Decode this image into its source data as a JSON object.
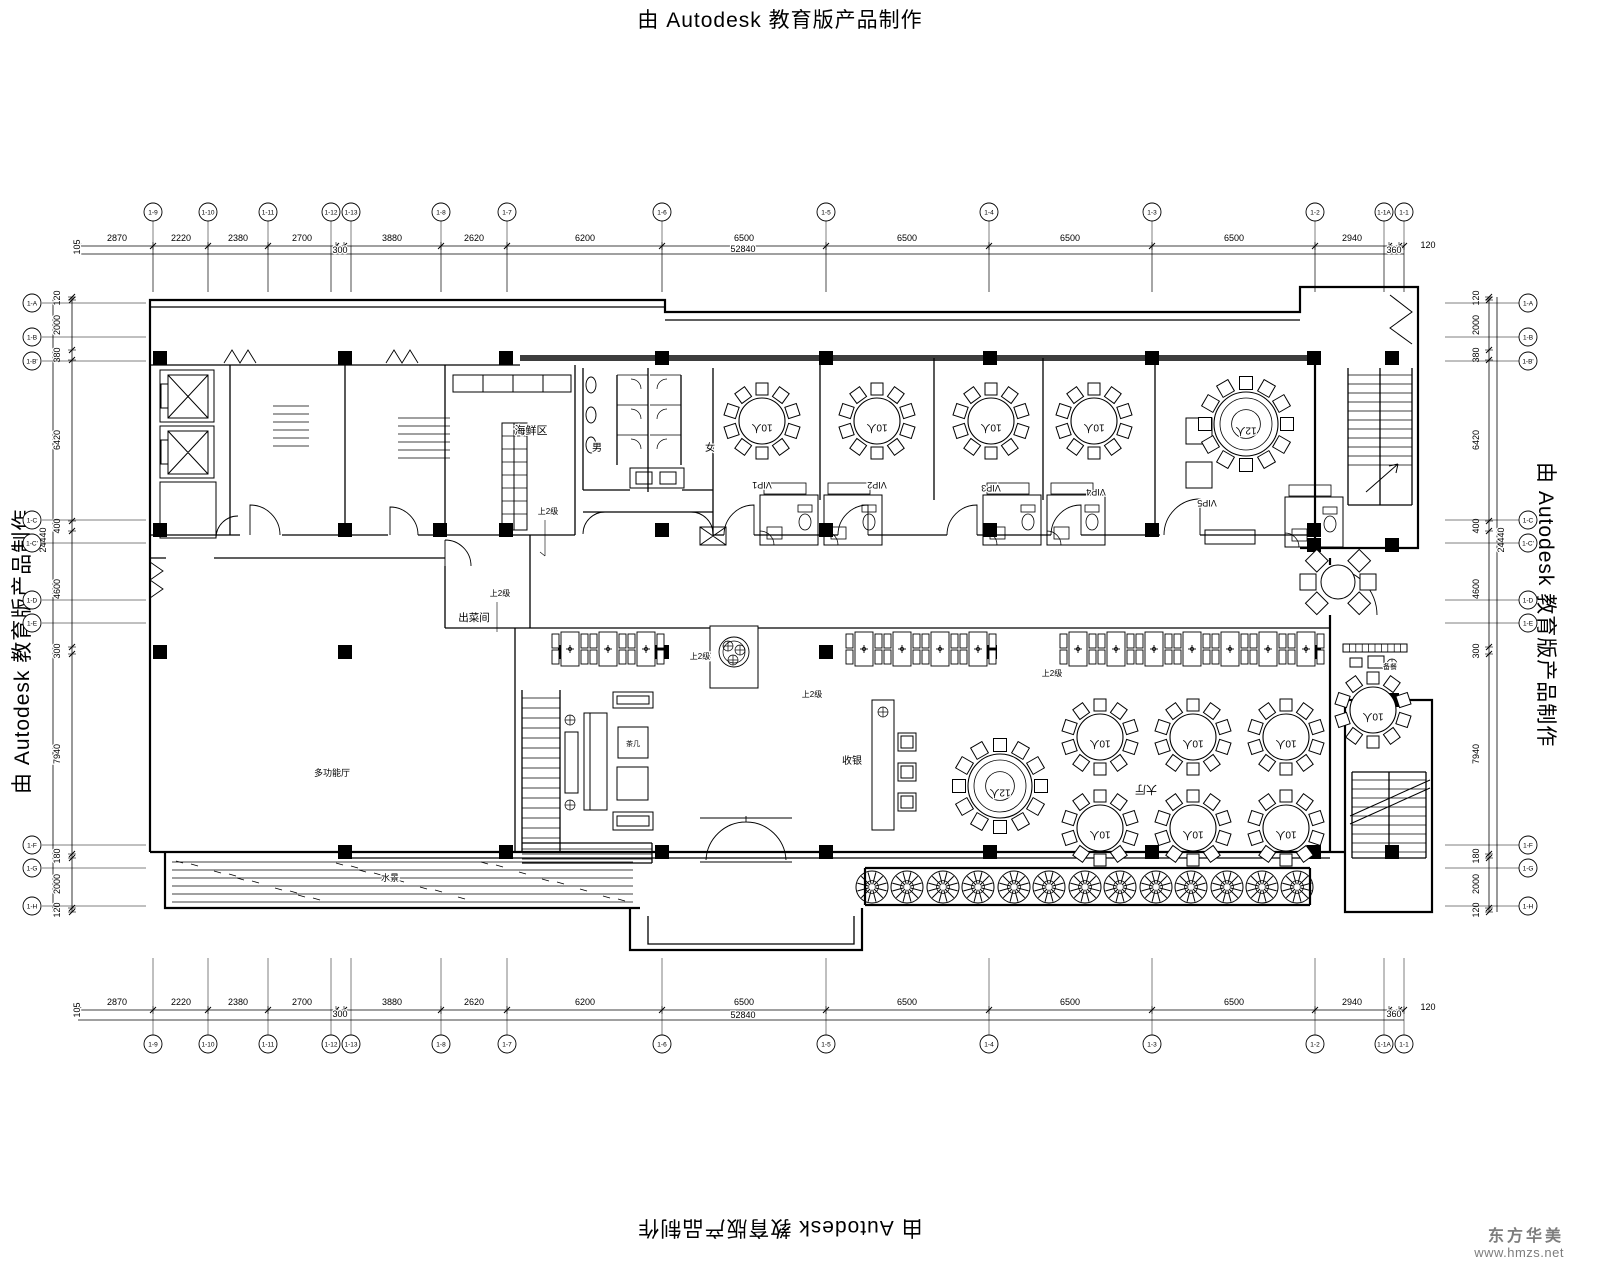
{
  "watermarks": {
    "top": "由 Autodesk 教育版产品制作",
    "left": "由 Autodesk 教育版产品制作",
    "right": "由 Autodesk 教育版产品制作",
    "bottom": "由 Autodesk 教育版产品制作"
  },
  "logo": {
    "name": "东方华美",
    "url": "www.hmzs.net",
    "color": "#7d7d7d"
  },
  "sheet": {
    "bg": "#ffffff",
    "line": "#000000",
    "heavy": "#3d3d3d"
  },
  "axes": {
    "top": {
      "y": 212,
      "labels": [
        "1-9",
        "1-10",
        "1-11",
        "1-12",
        "1-13",
        "1-8",
        "1-7",
        "1-6",
        "1-5",
        "1-4",
        "1-3",
        "1-2",
        "1-1A",
        "1-1"
      ],
      "x": [
        153,
        208,
        268,
        331,
        351,
        441,
        507,
        662,
        826,
        989,
        1152,
        1315,
        1384,
        1404
      ]
    },
    "bottom": {
      "y": 1044,
      "labels": [
        "1-9",
        "1-10",
        "1-11",
        "1-12",
        "1-13",
        "1-8",
        "1-7",
        "1-6",
        "1-5",
        "1-4",
        "1-3",
        "1-2",
        "1-1A",
        "1-1"
      ],
      "x": [
        153,
        208,
        268,
        331,
        351,
        441,
        507,
        662,
        826,
        989,
        1152,
        1315,
        1384,
        1404
      ]
    },
    "left": {
      "x": 32,
      "labels": [
        "1-A",
        "1-B",
        "1-B'",
        "1-C",
        "1-C'",
        "1-D",
        "1-E",
        "1-F",
        "1-G",
        "1-H"
      ],
      "y": [
        303,
        337,
        361,
        520,
        543,
        600,
        623,
        845,
        868,
        906
      ]
    },
    "right": {
      "x": 1528,
      "labels": [
        "1-A",
        "1-B",
        "1-B'",
        "1-C",
        "1-C'",
        "1-D",
        "1-E",
        "1-F",
        "1-G",
        "1-H"
      ],
      "y": [
        303,
        337,
        361,
        520,
        543,
        600,
        623,
        845,
        868,
        906
      ]
    }
  },
  "dimensions": {
    "top": {
      "items": [
        [
          "105",
          80,
          247,
          1
        ],
        [
          "2870",
          117,
          241,
          0
        ],
        [
          "2220",
          181,
          241,
          0
        ],
        [
          "2380",
          238,
          241,
          0
        ],
        [
          "2700",
          302,
          241,
          0
        ],
        [
          "300",
          340,
          253,
          0
        ],
        [
          "3880",
          392,
          241,
          0
        ],
        [
          "2620",
          474,
          241,
          0
        ],
        [
          "6200",
          585,
          241,
          0
        ],
        [
          "6500",
          744,
          241,
          0
        ],
        [
          "6500",
          907,
          241,
          0
        ],
        [
          "6500",
          1070,
          241,
          0
        ],
        [
          "6500",
          1234,
          241,
          0
        ],
        [
          "2940",
          1352,
          241,
          0
        ],
        [
          "360",
          1394,
          253,
          0
        ],
        [
          "120",
          1428,
          248,
          0
        ]
      ],
      "total": "52840"
    },
    "bottom": {
      "items": [
        [
          "105",
          80,
          1010,
          1
        ],
        [
          "2870",
          117,
          1005,
          0
        ],
        [
          "2220",
          181,
          1005,
          0
        ],
        [
          "2380",
          238,
          1005,
          0
        ],
        [
          "2700",
          302,
          1005,
          0
        ],
        [
          "300",
          340,
          1017,
          0
        ],
        [
          "3880",
          392,
          1005,
          0
        ],
        [
          "2620",
          474,
          1005,
          0
        ],
        [
          "6200",
          585,
          1005,
          0
        ],
        [
          "6500",
          744,
          1005,
          0
        ],
        [
          "6500",
          907,
          1005,
          0
        ],
        [
          "6500",
          1070,
          1005,
          0
        ],
        [
          "6500",
          1234,
          1005,
          0
        ],
        [
          "2940",
          1352,
          1005,
          0
        ],
        [
          "360",
          1394,
          1017,
          0
        ],
        [
          "120",
          1428,
          1010,
          0
        ]
      ],
      "total": "52840"
    },
    "left": {
      "items": [
        [
          "120",
          298
        ],
        [
          "2000",
          325
        ],
        [
          "380",
          355
        ],
        [
          "6420",
          440
        ],
        [
          "400",
          526
        ],
        [
          "4600",
          589
        ],
        [
          "300",
          651
        ],
        [
          "7940",
          754
        ],
        [
          "180",
          856
        ],
        [
          "2000",
          884
        ],
        [
          "120",
          910
        ]
      ],
      "total": "24440"
    },
    "right": {
      "items": [
        [
          "120",
          298
        ],
        [
          "2000",
          325
        ],
        [
          "380",
          355
        ],
        [
          "6420",
          440
        ],
        [
          "400",
          526
        ],
        [
          "4600",
          589
        ],
        [
          "300",
          651
        ],
        [
          "7940",
          754
        ],
        [
          "180",
          856
        ],
        [
          "2000",
          884
        ],
        [
          "120",
          910
        ]
      ],
      "total": "24440"
    }
  },
  "labels": [
    {
      "t": "海鲜区",
      "x": 531,
      "y": 434,
      "s": 11,
      "r": 0
    },
    {
      "t": "男",
      "x": 597,
      "y": 451,
      "s": 10,
      "r": 0
    },
    {
      "t": "女",
      "x": 710,
      "y": 451,
      "s": 10,
      "r": 0
    },
    {
      "t": "出菜间",
      "x": 474,
      "y": 621,
      "s": 10.5,
      "r": 0
    },
    {
      "t": "收银",
      "x": 852,
      "y": 764,
      "s": 10,
      "r": 0
    },
    {
      "t": "大厅",
      "x": 1146,
      "y": 786,
      "s": 11,
      "r": 180
    },
    {
      "t": "VIP1",
      "x": 762,
      "y": 482,
      "s": 9,
      "r": 180
    },
    {
      "t": "VIP2",
      "x": 877,
      "y": 482,
      "s": 9,
      "r": 180
    },
    {
      "t": "VIP3",
      "x": 991,
      "y": 485,
      "s": 9,
      "r": 180
    },
    {
      "t": "VIP4",
      "x": 1096,
      "y": 489,
      "s": 9,
      "r": 180
    },
    {
      "t": "VIP5",
      "x": 1207,
      "y": 500,
      "s": 9,
      "r": 180
    },
    {
      "t": "多功能厅",
      "x": 332,
      "y": 776,
      "s": 9,
      "r": 0
    },
    {
      "t": "水景",
      "x": 390,
      "y": 881,
      "s": 9,
      "r": 0
    },
    {
      "t": "茶几",
      "x": 633,
      "y": 746,
      "s": 7,
      "r": 0
    },
    {
      "t": "备餐",
      "x": 1390,
      "y": 669,
      "s": 7,
      "r": 0
    },
    {
      "t": "上2级",
      "x": 548,
      "y": 514,
      "s": 8,
      "r": 0
    },
    {
      "t": "上2级",
      "x": 500,
      "y": 596,
      "s": 8,
      "r": 0
    },
    {
      "t": "上2级",
      "x": 700,
      "y": 659,
      "s": 8,
      "r": 0
    },
    {
      "t": "上2级",
      "x": 812,
      "y": 697,
      "s": 8,
      "r": 0
    },
    {
      "t": "上2级",
      "x": 1052,
      "y": 676,
      "s": 8,
      "r": 0
    }
  ],
  "furniture": {
    "round_tables": [
      {
        "x": 762,
        "y": 421,
        "r": 23,
        "seats": 10,
        "label": "10人"
      },
      {
        "x": 877,
        "y": 421,
        "r": 23,
        "seats": 10,
        "label": "10人"
      },
      {
        "x": 991,
        "y": 421,
        "r": 23,
        "seats": 10,
        "label": "10人"
      },
      {
        "x": 1094,
        "y": 421,
        "r": 23,
        "seats": 10,
        "label": "10人"
      },
      {
        "x": 1246,
        "y": 424,
        "r": 32,
        "seats": 12,
        "label": "12人"
      },
      {
        "x": 1000,
        "y": 786,
        "r": 32,
        "seats": 12,
        "label": "12人"
      },
      {
        "x": 1100,
        "y": 737,
        "r": 23,
        "seats": 10,
        "label": "10人"
      },
      {
        "x": 1193,
        "y": 737,
        "r": 23,
        "seats": 10,
        "label": "10人"
      },
      {
        "x": 1286,
        "y": 737,
        "r": 23,
        "seats": 10,
        "label": "10人"
      },
      {
        "x": 1100,
        "y": 828,
        "r": 23,
        "seats": 10,
        "label": "10人"
      },
      {
        "x": 1193,
        "y": 828,
        "r": 23,
        "seats": 10,
        "label": "10人"
      },
      {
        "x": 1286,
        "y": 828,
        "r": 23,
        "seats": 10,
        "label": "10人"
      },
      {
        "x": 1373,
        "y": 710,
        "r": 23,
        "seats": 10,
        "label": "10人"
      }
    ],
    "waiting_table": {
      "x": 1338,
      "y": 582,
      "r": 17
    },
    "booths": {
      "y": 630,
      "groups": [
        [
          552,
          590,
          628
        ],
        [
          846,
          884,
          922,
          960
        ],
        [
          1060,
          1098,
          1136,
          1174,
          1212,
          1250,
          1288
        ]
      ]
    },
    "trees": {
      "y": 887,
      "r": 16,
      "x": [
        872,
        907,
        943,
        978,
        1014,
        1049,
        1085,
        1120,
        1156,
        1191,
        1227,
        1262,
        1297
      ]
    },
    "columns": [
      [
        160,
        358
      ],
      [
        345,
        358
      ],
      [
        506,
        358
      ],
      [
        662,
        358
      ],
      [
        826,
        358
      ],
      [
        990,
        358
      ],
      [
        1152,
        358
      ],
      [
        1314,
        358
      ],
      [
        1392,
        358
      ],
      [
        160,
        530
      ],
      [
        345,
        530
      ],
      [
        440,
        530
      ],
      [
        506,
        530
      ],
      [
        662,
        530
      ],
      [
        826,
        530
      ],
      [
        990,
        530
      ],
      [
        1152,
        530
      ],
      [
        1314,
        530
      ],
      [
        160,
        652
      ],
      [
        345,
        652
      ],
      [
        565,
        652
      ],
      [
        662,
        652
      ],
      [
        826,
        652
      ],
      [
        990,
        652
      ],
      [
        1152,
        652
      ],
      [
        1190,
        652
      ],
      [
        1314,
        652
      ],
      [
        345,
        852
      ],
      [
        506,
        852
      ],
      [
        662,
        852
      ],
      [
        826,
        852
      ],
      [
        990,
        852
      ],
      [
        1152,
        852
      ],
      [
        1314,
        852
      ],
      [
        1392,
        852
      ],
      [
        1314,
        545
      ],
      [
        1392,
        545
      ],
      [
        1392,
        700
      ]
    ],
    "bathrooms": [
      [
        760,
        495
      ],
      [
        824,
        495
      ],
      [
        983,
        495
      ],
      [
        1047,
        495
      ],
      [
        1285,
        497
      ]
    ]
  }
}
